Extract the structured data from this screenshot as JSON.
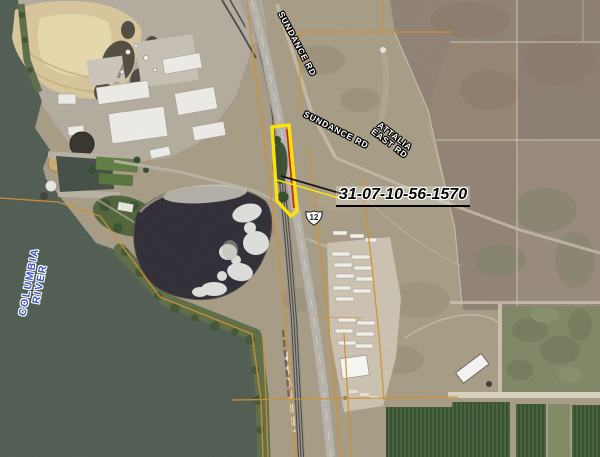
{
  "map": {
    "type": "aerial-parcel-map",
    "parcel_label": "31-07-10-56-1570",
    "highway_shield": "12",
    "road_labels": {
      "sundance_top": "SUNDANCE RD",
      "sundance_east": "SUNDANCE RD",
      "attalia_line1": "ATTALIA",
      "attalia_line2": "EAST RD"
    },
    "water_label": {
      "line1": "COLUMBIA",
      "line2": "RIVER"
    },
    "colors": {
      "parcel_highlight": "#ffe400",
      "parcel_inner_boundary": "#cc2200",
      "parcel_line_orange": "#d28f2e",
      "water": "#4e5b51",
      "water_label_blue": "#3b55c4"
    }
  }
}
